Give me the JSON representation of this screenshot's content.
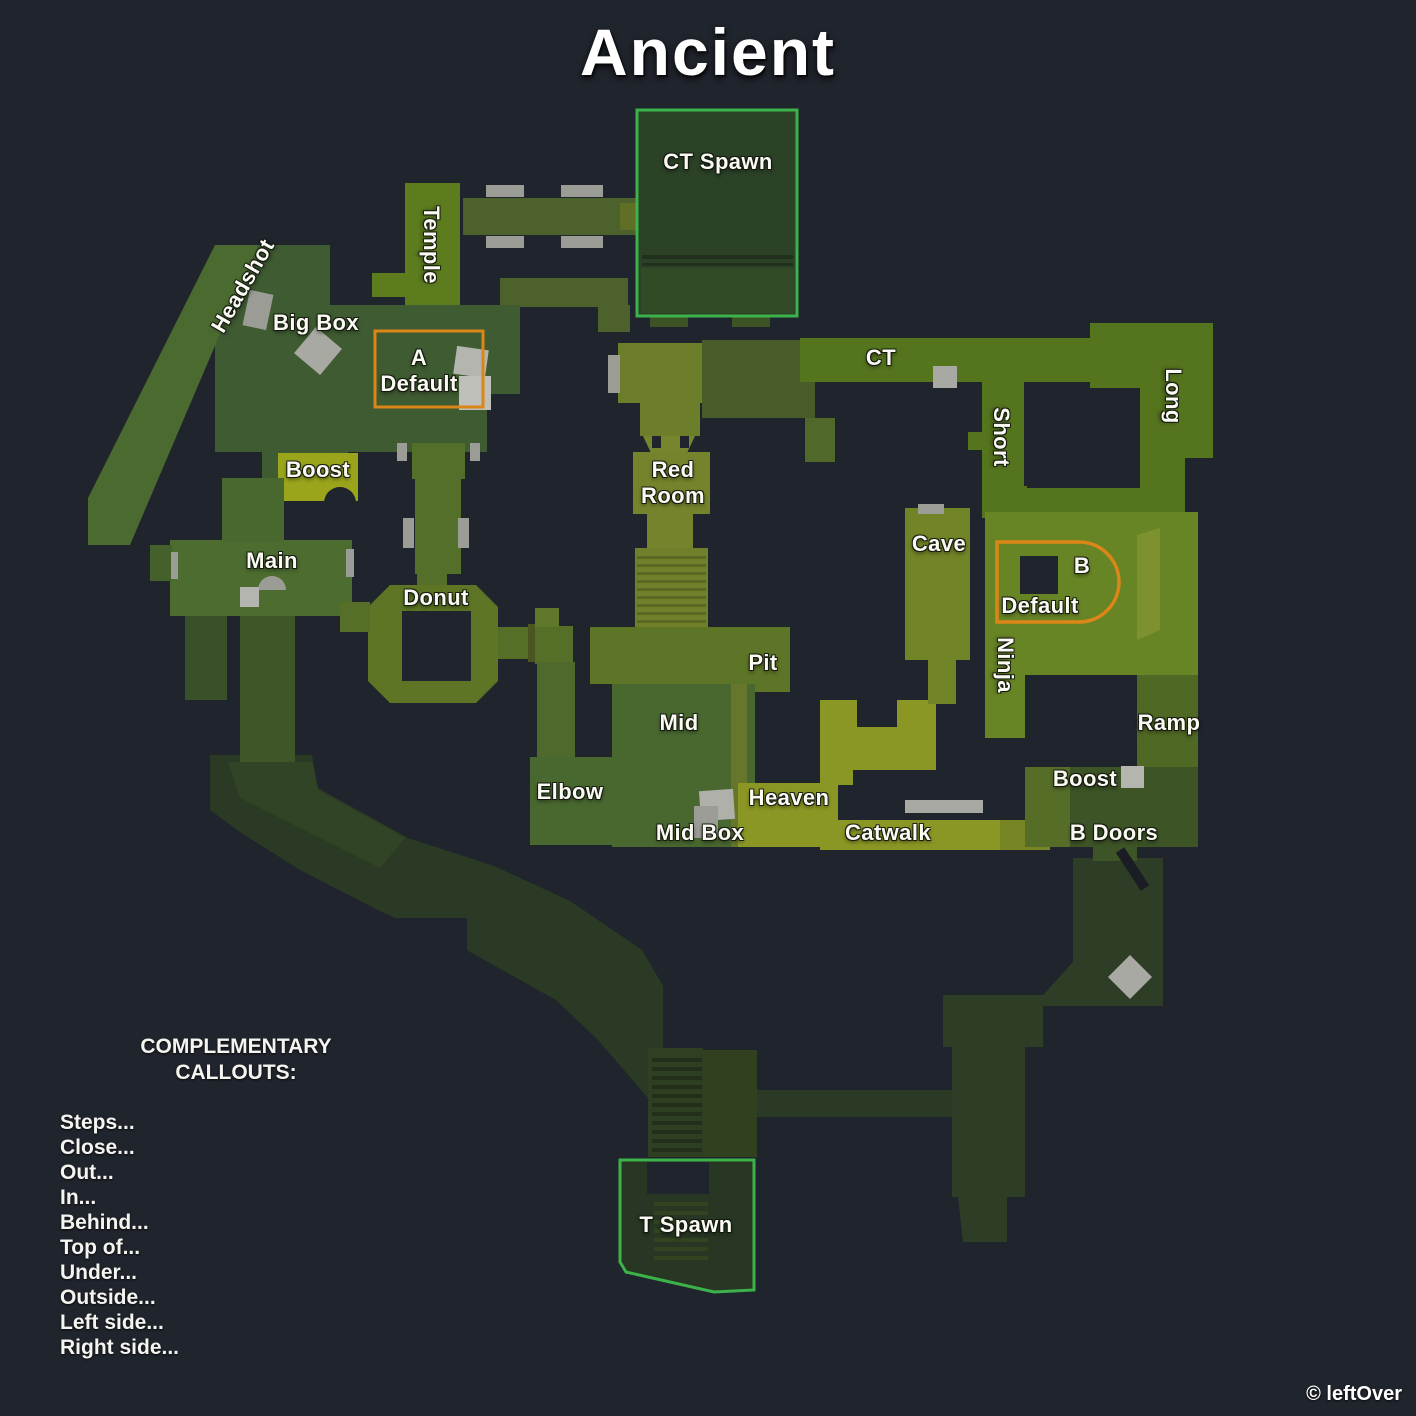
{
  "title": "Ancient",
  "credit": "© leftOver",
  "colors": {
    "background": "#20242c",
    "spawn_outline_green": "#3cb24a",
    "site_outline_orange": "#dd8618",
    "label_text": "#fafaf2",
    "map_green_bright": "#55741e",
    "map_olive": "#6d7e2a",
    "map_dark_road": "#2b3a24"
  },
  "complementary": {
    "heading": "COMPLEMENTARY\nCALLOUTS:",
    "items": [
      "Steps...",
      "Close...",
      "Out...",
      "In...",
      "Behind...",
      "Top of...",
      "Under...",
      "Outside...",
      "Left side...",
      "Right side..."
    ]
  },
  "map": {
    "callouts": [
      {
        "name": "ct-spawn",
        "label": "CT Spawn",
        "x": 718,
        "y": 162,
        "rot": 0
      },
      {
        "name": "temple",
        "label": "Temple",
        "x": 431,
        "y": 245,
        "rot": 90
      },
      {
        "name": "headshot",
        "label": "Headshot",
        "x": 243,
        "y": 286,
        "rot": -60
      },
      {
        "name": "big-box",
        "label": "Big Box",
        "x": 316,
        "y": 323,
        "rot": 0
      },
      {
        "name": "a-default",
        "label": "A\nDefault",
        "x": 419,
        "y": 371,
        "rot": 0
      },
      {
        "name": "boost-a",
        "label": "Boost",
        "x": 318,
        "y": 470,
        "rot": 0
      },
      {
        "name": "main",
        "label": "Main",
        "x": 272,
        "y": 561,
        "rot": 0
      },
      {
        "name": "donut",
        "label": "Donut",
        "x": 436,
        "y": 598,
        "rot": 0
      },
      {
        "name": "red-room",
        "label": "Red\nRoom",
        "x": 673,
        "y": 483,
        "rot": 0
      },
      {
        "name": "ct",
        "label": "CT",
        "x": 881,
        "y": 358,
        "rot": 0
      },
      {
        "name": "short",
        "label": "Short",
        "x": 1001,
        "y": 437,
        "rot": 90
      },
      {
        "name": "long",
        "label": "Long",
        "x": 1173,
        "y": 396,
        "rot": 90
      },
      {
        "name": "cave",
        "label": "Cave",
        "x": 939,
        "y": 544,
        "rot": 0
      },
      {
        "name": "b",
        "label": "B",
        "x": 1082,
        "y": 566,
        "rot": 0
      },
      {
        "name": "b-default",
        "label": "Default",
        "x": 1040,
        "y": 606,
        "rot": 0
      },
      {
        "name": "ninja",
        "label": "Ninja",
        "x": 1005,
        "y": 665,
        "rot": 90
      },
      {
        "name": "pit",
        "label": "Pit",
        "x": 763,
        "y": 663,
        "rot": 0
      },
      {
        "name": "mid",
        "label": "Mid",
        "x": 679,
        "y": 723,
        "rot": 0
      },
      {
        "name": "elbow",
        "label": "Elbow",
        "x": 570,
        "y": 792,
        "rot": 0
      },
      {
        "name": "heaven",
        "label": "Heaven",
        "x": 789,
        "y": 798,
        "rot": 0
      },
      {
        "name": "mid-box",
        "label": "Mid Box",
        "x": 700,
        "y": 833,
        "rot": 0
      },
      {
        "name": "catwalk",
        "label": "Catwalk",
        "x": 888,
        "y": 833,
        "rot": 0
      },
      {
        "name": "ramp",
        "label": "Ramp",
        "x": 1169,
        "y": 723,
        "rot": 0
      },
      {
        "name": "boost-b",
        "label": "Boost",
        "x": 1085,
        "y": 779,
        "rot": 0
      },
      {
        "name": "b-doors",
        "label": "B Doors",
        "x": 1114,
        "y": 833,
        "rot": 0
      },
      {
        "name": "t-spawn",
        "label": "T Spawn",
        "x": 686,
        "y": 1225,
        "rot": 0
      }
    ]
  }
}
